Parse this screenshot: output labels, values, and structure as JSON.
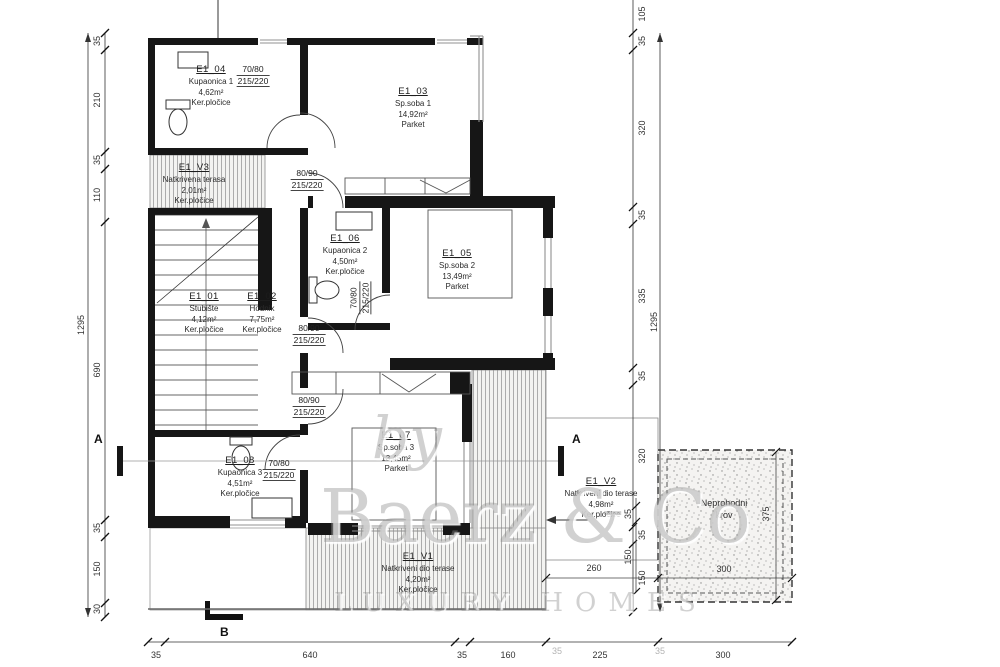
{
  "watermark": {
    "by": "by",
    "brand": "Baerz & Co",
    "tagline": "LUXURY HOMES"
  },
  "rooms": [
    {
      "id": "E1_04",
      "name": "Kupaonica 1",
      "area": "4,62m²",
      "floor": "Ker.pločice"
    },
    {
      "id": "E1_03",
      "name": "Sp.soba 1",
      "area": "14,92m²",
      "floor": "Parket"
    },
    {
      "id": "E1_V3",
      "name": "Natkrivena terasa",
      "area": "2,01m²",
      "floor": "Ker.pločice"
    },
    {
      "id": "E1_06",
      "name": "Kupaonica 2",
      "area": "4,50m²",
      "floor": "Ker.pločice"
    },
    {
      "id": "E1_05",
      "name": "Sp.soba 2",
      "area": "13,49m²",
      "floor": "Parket"
    },
    {
      "id": "E1_01",
      "name": "Stubište",
      "area": "4,12m²",
      "floor": "Ker.pločice"
    },
    {
      "id": "E1_02",
      "name": "Hodnik",
      "area": "7,75m²",
      "floor": "Ker.pločice"
    },
    {
      "id": "E1_08",
      "name": "Kupaonica 3",
      "area": "4,51m²",
      "floor": "Ker.pločice"
    },
    {
      "id": "E1_07",
      "name": "Sp.soba 3",
      "area": "13,45m²",
      "floor": "Parket"
    },
    {
      "id": "E1_V2",
      "name": "Natkriveni dio terase",
      "area": "4,98m²",
      "floor": "Ker.pločice"
    },
    {
      "id": "E1_V1",
      "name": "Natkriveni dio terase",
      "area": "4,20m²",
      "floor": "Ker.pločice"
    }
  ],
  "roof": {
    "label1": "Neprohodni",
    "label2": "krov"
  },
  "door_labels": [
    {
      "size": "70/80",
      "height": "215/220"
    },
    {
      "size": "80/90",
      "height": "215/220"
    },
    {
      "size": "70/80",
      "height": "215/220"
    },
    {
      "size": "80/90",
      "height": "215/220"
    },
    {
      "size": "80/90",
      "height": "215/220"
    },
    {
      "size": "70/80",
      "height": "215/220"
    }
  ],
  "dims": {
    "left": [
      "35",
      "210",
      "35",
      "110",
      "690",
      "35",
      "150",
      "30"
    ],
    "left_total": "1295",
    "right": [
      "105",
      "35",
      "320",
      "35",
      "335",
      "35",
      "320",
      "35",
      "150"
    ],
    "right_total": "1295",
    "bottom": [
      "35",
      "640",
      "35",
      "160",
      "225",
      "300"
    ],
    "bottom_faint": [
      "35",
      "35"
    ],
    "terrace": {
      "w": "260",
      "a": "35",
      "b": "150"
    },
    "roof": {
      "w": "300",
      "h": "375"
    }
  },
  "sections": {
    "a": "A",
    "b": "B"
  }
}
